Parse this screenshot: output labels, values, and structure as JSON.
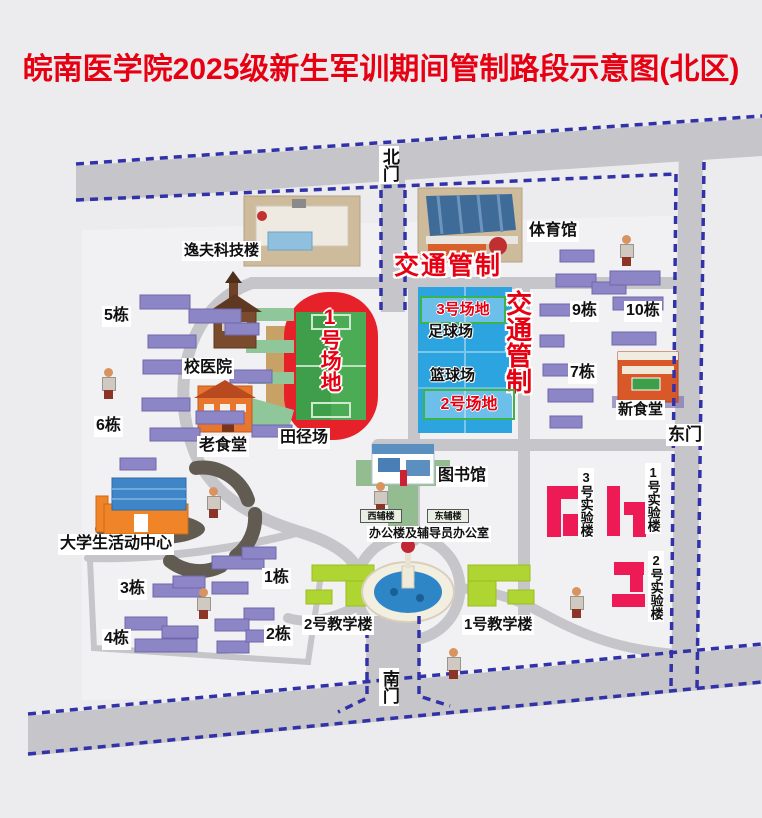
{
  "title": "皖南医学院2025级新生军训期间管制路段示意图(北区)",
  "watermark": "皖南医学院",
  "gates": {
    "north": "北门",
    "east": "东门",
    "south": "南门"
  },
  "traffic_control": {
    "top": "交通管制",
    "side": "交通管制"
  },
  "fields": {
    "field1": "1号场地",
    "field2": "2号场地",
    "field3": "3号场地",
    "track": "田径场",
    "football": "足球场",
    "basketball": "篮球场"
  },
  "buildings": {
    "yifu": "逸夫科技楼",
    "gym": "体育馆",
    "hospital": "校医院",
    "old_canteen": "老食堂",
    "new_canteen": "新食堂",
    "library": "图书馆",
    "activity_center": "大学生活动中心",
    "office": "办公楼及辅导员办公室",
    "west_annex": "西辅楼",
    "east_annex": "东辅楼",
    "teach1": "1号教学楼",
    "teach2": "2号教学楼",
    "lab1": "1号实验楼",
    "lab2": "2号实验楼",
    "lab3": "3号实验楼"
  },
  "dorms": {
    "d1": "1栋",
    "d2": "2栋",
    "d3": "3栋",
    "d4": "4栋",
    "d5": "5栋",
    "d6": "6栋",
    "d7": "7栋",
    "d9": "9栋",
    "d10": "10栋"
  },
  "colors": {
    "title_red": "#e60012",
    "control_red": "#e60012",
    "road_gray": "#c6c5c9",
    "dash_blue": "#3232a8",
    "dorm_purple": "#8c85c6",
    "court_blue": "#2ba4df",
    "track_red": "#e62129",
    "field_green": "#42a14c",
    "teaching_green": "#aed531",
    "lab_pink": "#ee1a55",
    "zone_box_green": "#3cb44a"
  }
}
